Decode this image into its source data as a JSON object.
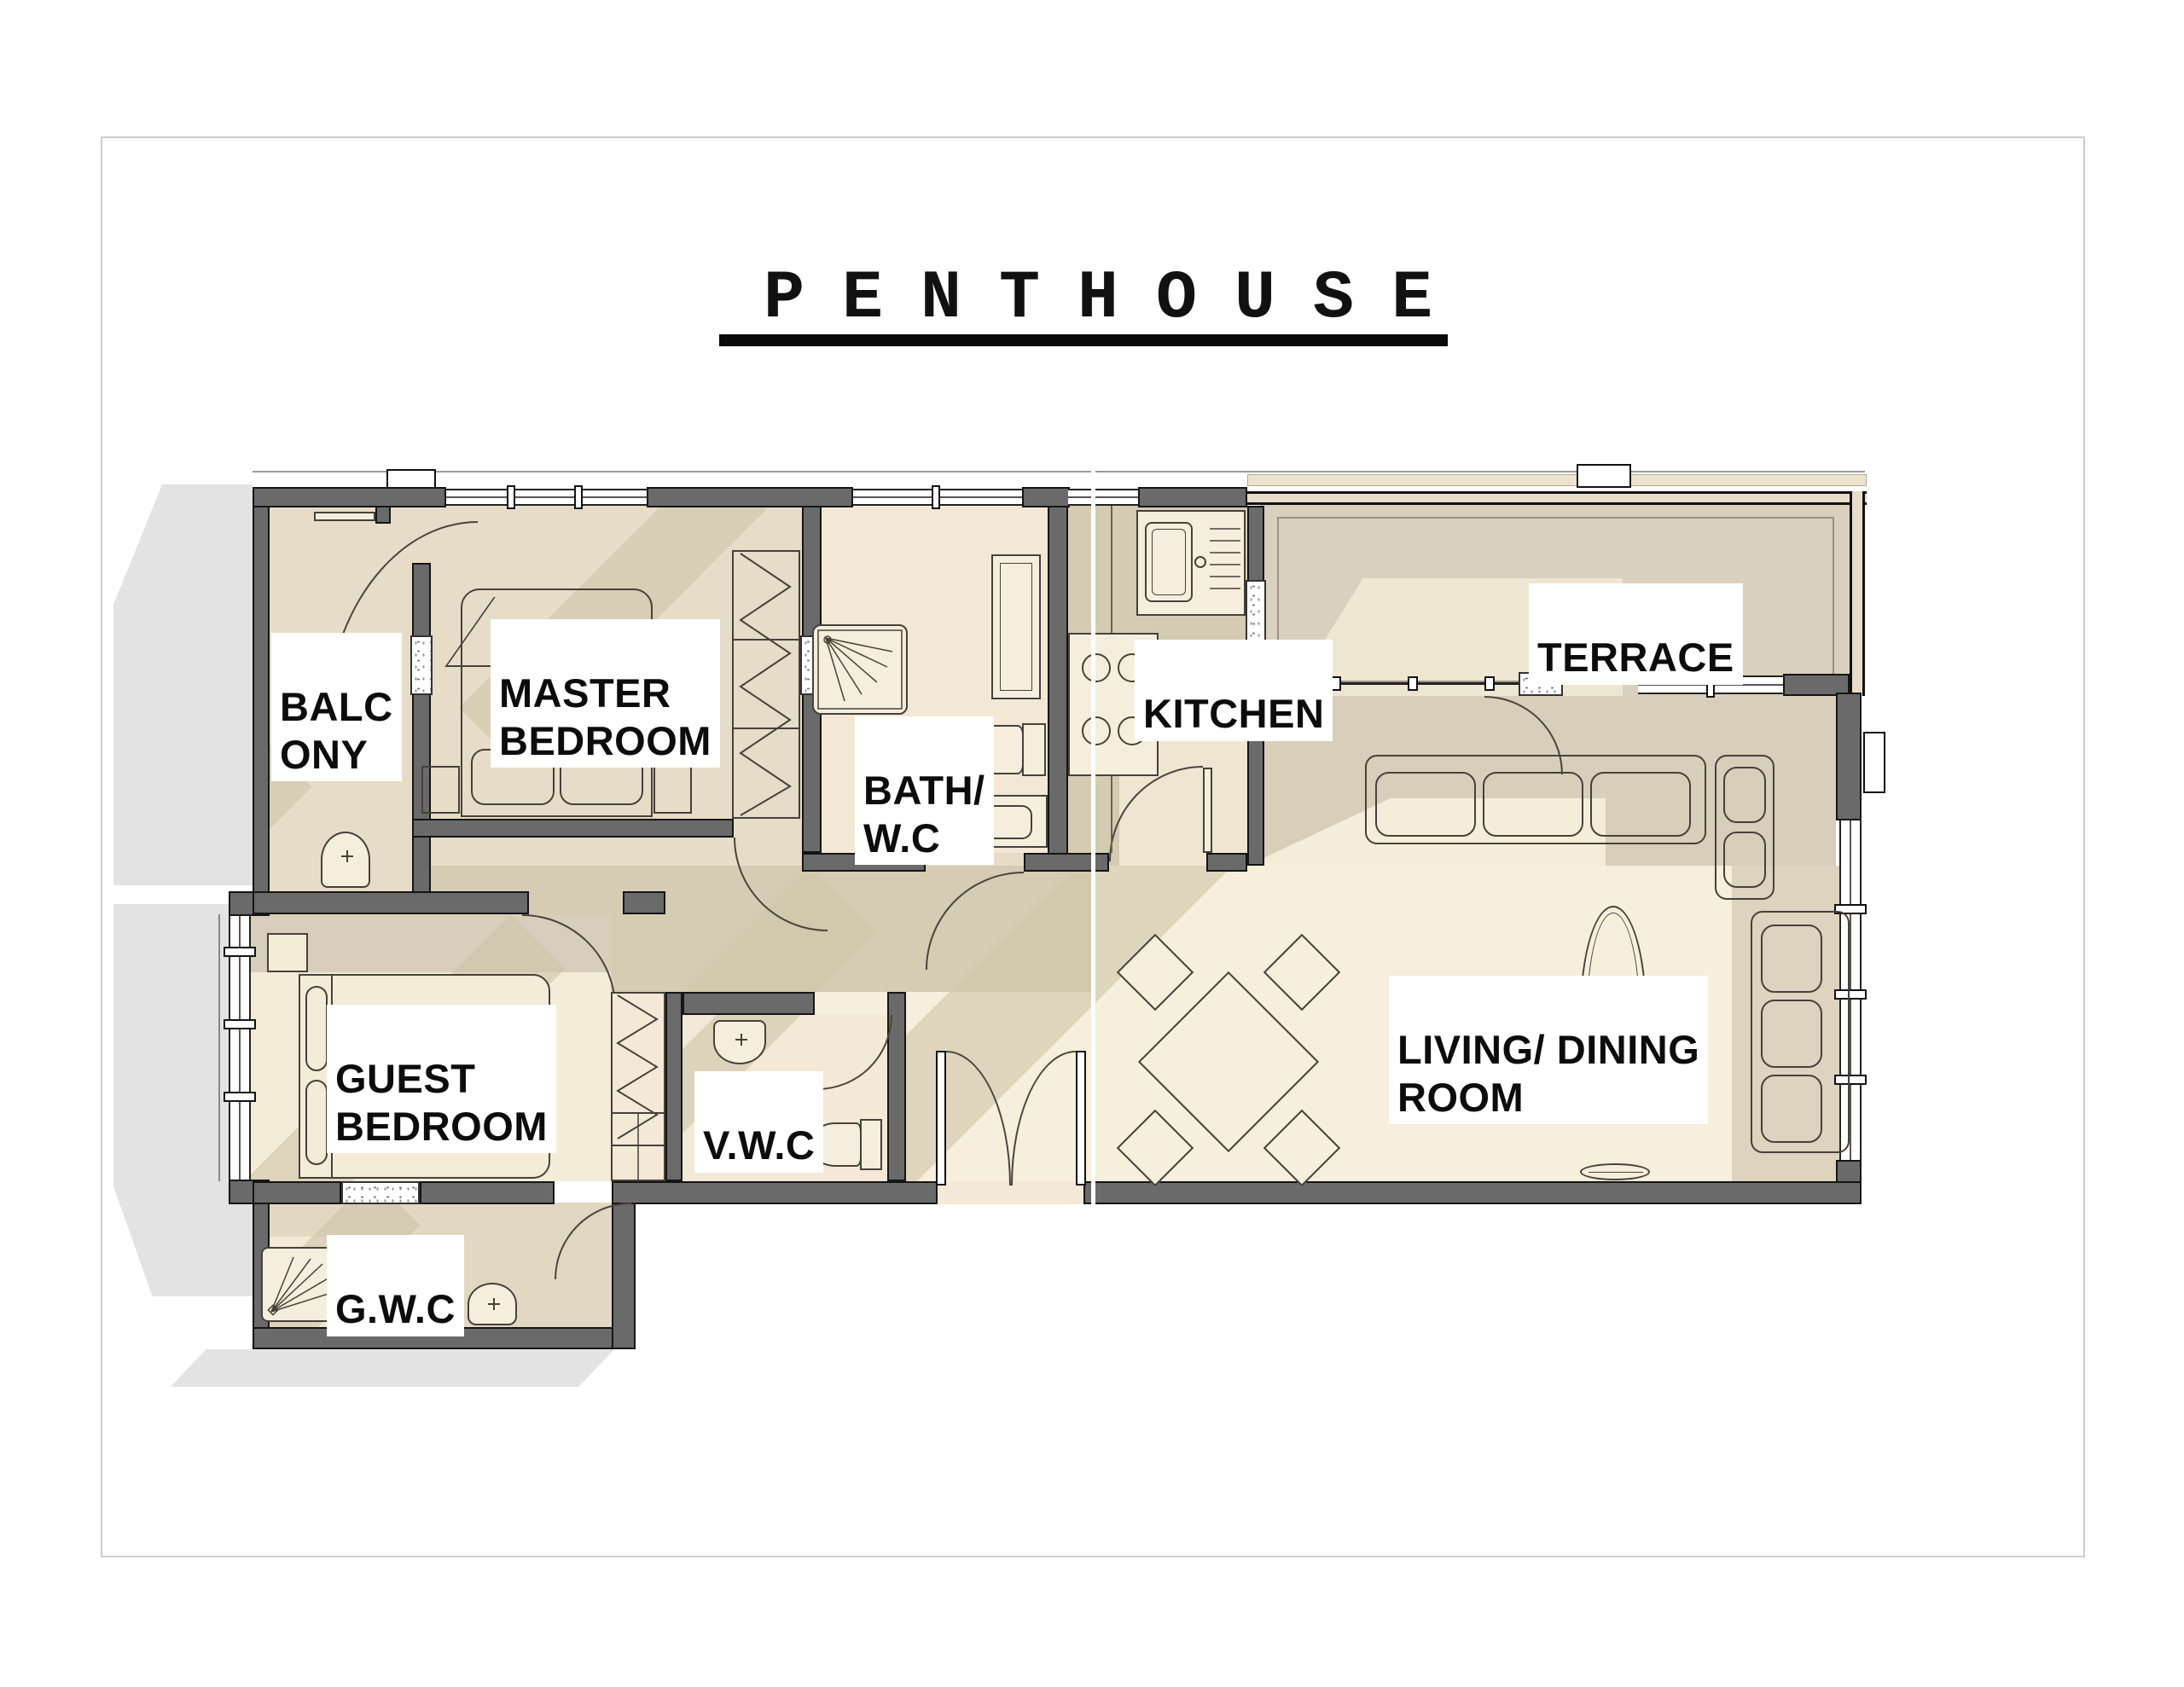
{
  "page": {
    "title": "PENTHOUSE"
  },
  "rooms": {
    "balcony": {
      "line1": "BALC",
      "line2": "ONY"
    },
    "master": {
      "line1": "MASTER",
      "line2": "BEDROOM"
    },
    "bath": {
      "line1": "BATH/",
      "line2": "W.C"
    },
    "kitchen": {
      "label": "KITCHEN"
    },
    "terrace": {
      "label": "TERRACE"
    },
    "guest": {
      "line1": "GUEST",
      "line2": "BEDROOM"
    },
    "vwc": {
      "label": "V.W.C"
    },
    "living": {
      "line1": "LIVING/ DINING",
      "line2": "ROOM"
    },
    "gwc": {
      "label": "G.W.C"
    }
  },
  "icons": {
    "beds": [
      "master-bed-icon",
      "guest-bed-icon"
    ],
    "fixtures": [
      "shower-icon",
      "toilet-icon",
      "washbasin-icon",
      "vanity-sink-icon",
      "kitchen-sink-icon",
      "stove-icon"
    ],
    "furniture": [
      "wardrobe-icon",
      "sofa-icon",
      "corner-sofa-icon",
      "coffee-table-icon",
      "dining-table-icon",
      "dining-chair-icon",
      "plate-icon"
    ],
    "architecture": [
      "door-swing-icon",
      "double-entry-door-icon",
      "window-icon",
      "railing-icon",
      "chimney-icon"
    ]
  },
  "colors": {
    "wall": "#6a6a6a",
    "floor_light": "#f7eedb",
    "floor_mid": "#e6dcc7",
    "floor_tan": "#d6ccb3",
    "terrace_floor": "#d9d0bd",
    "outside_shadow": "#e3e3e3",
    "ink": "#111111"
  }
}
